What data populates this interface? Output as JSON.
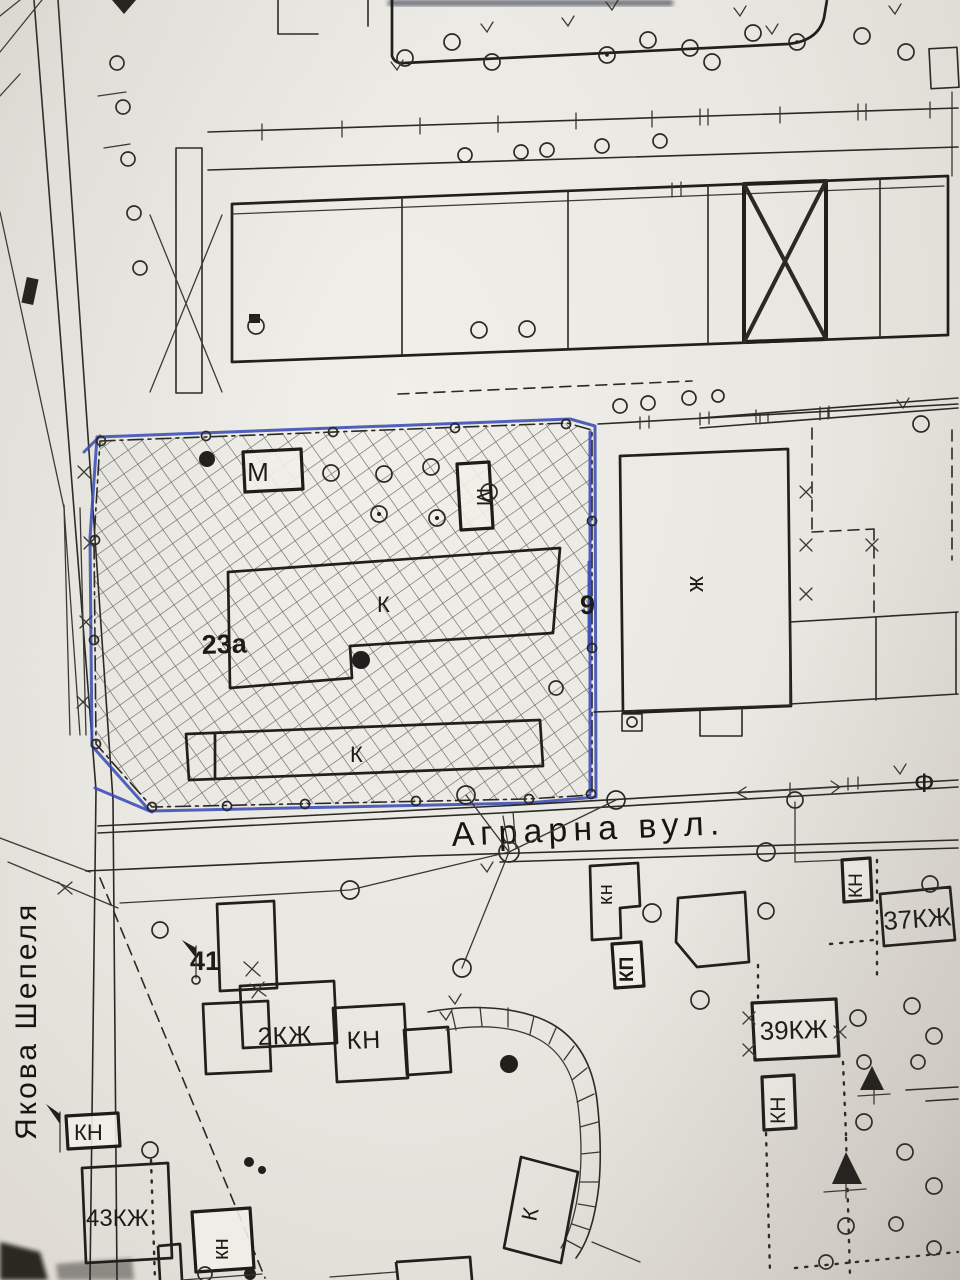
{
  "colors": {
    "ink": "#23221f",
    "blue_pen": "#3a4cb4",
    "paper": "#e9e7e1"
  },
  "streets": {
    "agrarna": "Аграрна вул.",
    "yakova_shepelya": "Якова Шепеля"
  },
  "parcel": {
    "number": "23а",
    "letter_k_upper": "К",
    "letter_k_lower": "К",
    "box_m": "М",
    "box_m_side": "М",
    "edge_number": "9"
  },
  "labels": {
    "zh_right": "ж",
    "house_2kzh": "2КЖ",
    "house_kn": "КН",
    "house_41": "41",
    "house_37kzh": "37КЖ",
    "house_39kzh": "39КЖ",
    "house_43kzh": "43КЖ",
    "kn_center_small": "кн",
    "kp_center": "КП",
    "kn_right_upper": "КН",
    "kn_right_lower": "КН",
    "kn_left": "КН",
    "kn_bottom": "кн",
    "k_slanted": "К",
    "f_symbol": "Ф"
  }
}
